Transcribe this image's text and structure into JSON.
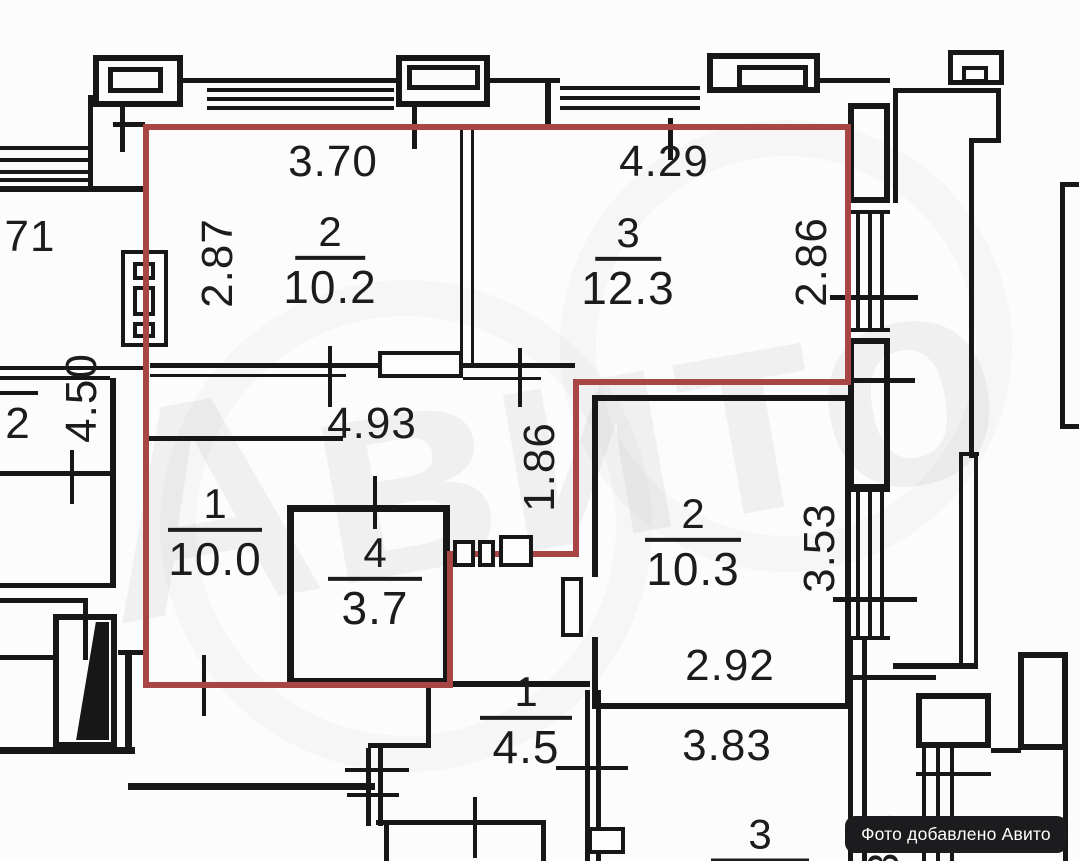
{
  "watermark": "Авито",
  "badge": {
    "label": "Фото добавлено Авито",
    "bg": "#1c1c1e",
    "fg": "#ffffff"
  },
  "outline_color": "#a84545",
  "apartment": {
    "room2": {
      "number": "2",
      "area": "10.2",
      "width": "3.70",
      "height": "2.87"
    },
    "room3": {
      "number": "3",
      "area": "12.3",
      "width": "4.29",
      "height": "2.86"
    },
    "room1": {
      "number": "1",
      "area": "10.0"
    },
    "room4": {
      "number": "4",
      "area": "3.7"
    },
    "hall": {
      "width": "4.93",
      "height": "1.86"
    },
    "side_height": "4.50"
  },
  "neighbor": {
    "room2": {
      "number": "2",
      "area": "10.3",
      "height": "3.53",
      "width": "2.92"
    },
    "bath": {
      "number": "1",
      "area": "4.5"
    },
    "room3": {
      "number": "3",
      "width": "3.83",
      "side": "3.3"
    },
    "left_top_partial": "71",
    "left_room_partial": "2"
  }
}
